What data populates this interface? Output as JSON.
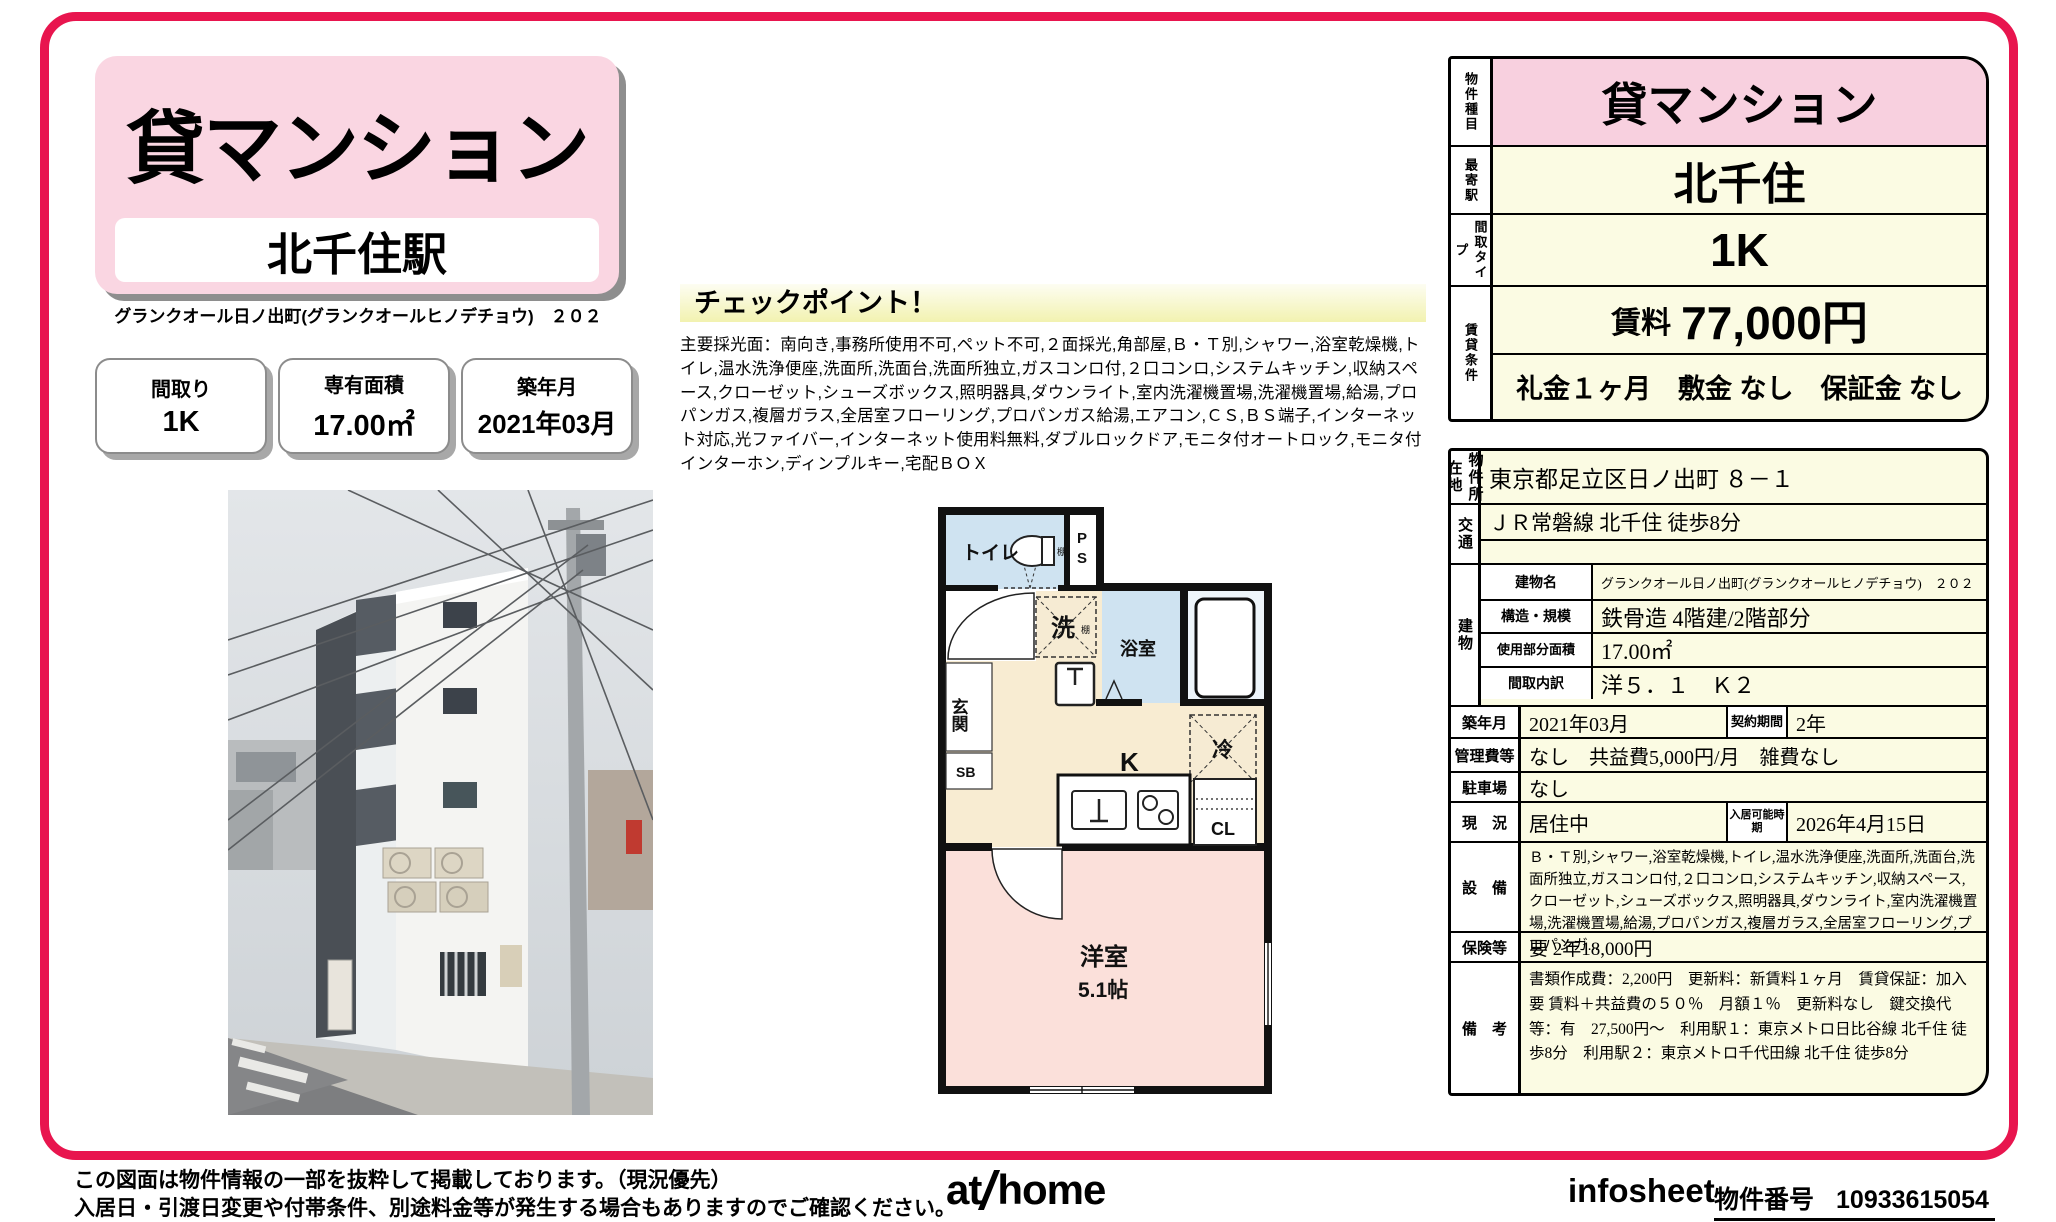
{
  "header": {
    "category": "貸マンション",
    "station": "北千住駅",
    "building_line": "グランクオール日ノ出町(グランクオールヒノデチョウ)　２０２",
    "spec_boxes": [
      {
        "label": "間取り",
        "value": "1K"
      },
      {
        "label": "専有面積",
        "value": "17.00㎡"
      },
      {
        "label": "築年月",
        "value": "2021年03月"
      }
    ]
  },
  "checkpoint": {
    "title": "チェックポイント！",
    "body": "主要採光面：南向き,事務所使用不可,ペット不可,２面採光,角部屋,Ｂ・Ｔ別,シャワー,浴室乾燥機,トイレ,温水洗浄便座,洗面所,洗面台,洗面所独立,ガスコンロ付,２口コンロ,システムキッチン,収納スペース,クローゼット,シューズボックス,照明器具,ダウンライト,室内洗濯機置場,洗濯機置場,給湯,プロパンガス,複層ガラス,全居室フローリング,プロパンガス給湯,エアコン,ＣＳ,ＢＳ端子,インターネット対応,光ファイバー,インターネット使用料無料,ダブルロックドア,モニタ付オートロック,モニタ付インターホン,ディンプルキー,宅配ＢＯＸ"
  },
  "summary_table": {
    "property_type": {
      "label": "物件種目",
      "value": "貸マンション"
    },
    "station": {
      "label": "最寄駅",
      "value": "北千住"
    },
    "layout_type": {
      "label": "間取タイプ",
      "value": "1K"
    },
    "conditions": {
      "label": "賃貸条件",
      "rent_label": "賃料",
      "rent_value": "77,000円",
      "fees": "礼金１ヶ月　敷金 なし　保証金 なし"
    }
  },
  "detail_table": {
    "address": {
      "label": "物件所在地",
      "value": "東京都足立区日ノ出町 ８－１"
    },
    "access": {
      "label": "交通",
      "line1": "ＪＲ常磐線 北千住 徒歩8分",
      "line2": ""
    },
    "building": {
      "label": "建物",
      "name": {
        "label": "建物名",
        "value": "グランクオール日ノ出町(グランクオールヒノデチョウ)　２０２"
      },
      "structure": {
        "label": "構造・規模",
        "value": "鉄骨造 4階建/2階部分"
      },
      "area": {
        "label": "使用部分面積",
        "value": "17.00㎡"
      },
      "layout": {
        "label": "間取内訳",
        "value": "洋５．１　Ｋ２"
      }
    },
    "built": {
      "label": "築年月",
      "value": "2021年03月",
      "label2": "契約期間",
      "value2": "2年"
    },
    "management": {
      "label": "管理費等",
      "value": "なし　共益費5,000円/月　雑費なし"
    },
    "parking": {
      "label": "駐車場",
      "value": "なし"
    },
    "status": {
      "label": "現　況",
      "value": "居住中",
      "label2": "入居可能時期",
      "value2": "2026年4月15日"
    },
    "equipment": {
      "label": "設　備",
      "value": "Ｂ・Ｔ別,シャワー,浴室乾燥機,トイレ,温水洗浄便座,洗面所,洗面台,洗面所独立,ガスコンロ付,２口コンロ,システムキッチン,収納スペース,クローゼット,シューズボックス,照明器具,ダウンライト,室内洗濯機置場,洗濯機置場,給湯,プロパンガス,複層ガラス,全居室フローリング,プロパンガ..."
    },
    "insurance": {
      "label": "保険等",
      "value": "要 2年18,000円"
    },
    "notes": {
      "label": "備　考",
      "value": "書類作成費：2,200円　更新料：新賃料１ヶ月　賃貸保証：加入要 賃料＋共益費の５０％　月額１％　更新料なし　鍵交換代等：有　27,500円～　利用駅１：東京メトロ日比谷線 北千住 徒歩8分　利用駅２：東京メトロ千代田線 北千住 徒歩8分"
    }
  },
  "floorplan": {
    "toilet": "トイレ",
    "shelf": "棚",
    "ps_p": "P",
    "ps_s": "S",
    "bath": "浴室",
    "washer": "洗",
    "washer_shelf": "棚",
    "entrance": "玄関",
    "shoebox": "SB",
    "kitchen": "K",
    "fridge": "冷",
    "closet": "CL",
    "room": "洋室",
    "room_size": "5.1帖"
  },
  "footer": {
    "disclaimer1": "この図面は物件情報の一部を抜粋して掲載しております。（現況優先）",
    "disclaimer2": "入居日・引渡日変更や付帯条件、別途料金等が発生する場合もありますのでご確認ください。",
    "logo_at": "at",
    "logo_home": "home",
    "infosheet": "infosheet",
    "property_no_label": "物件番号",
    "property_no": "10933615054"
  },
  "colors": {
    "frame_pink": "#e8154e",
    "panel_pink": "#fad6e2",
    "cell_pink": "#f8d0df",
    "cell_cream": "#fbfbe3",
    "plan_beige": "#f8ecd2",
    "plan_blue": "#cfe3f1",
    "plan_room_pink": "#fbe0da"
  }
}
